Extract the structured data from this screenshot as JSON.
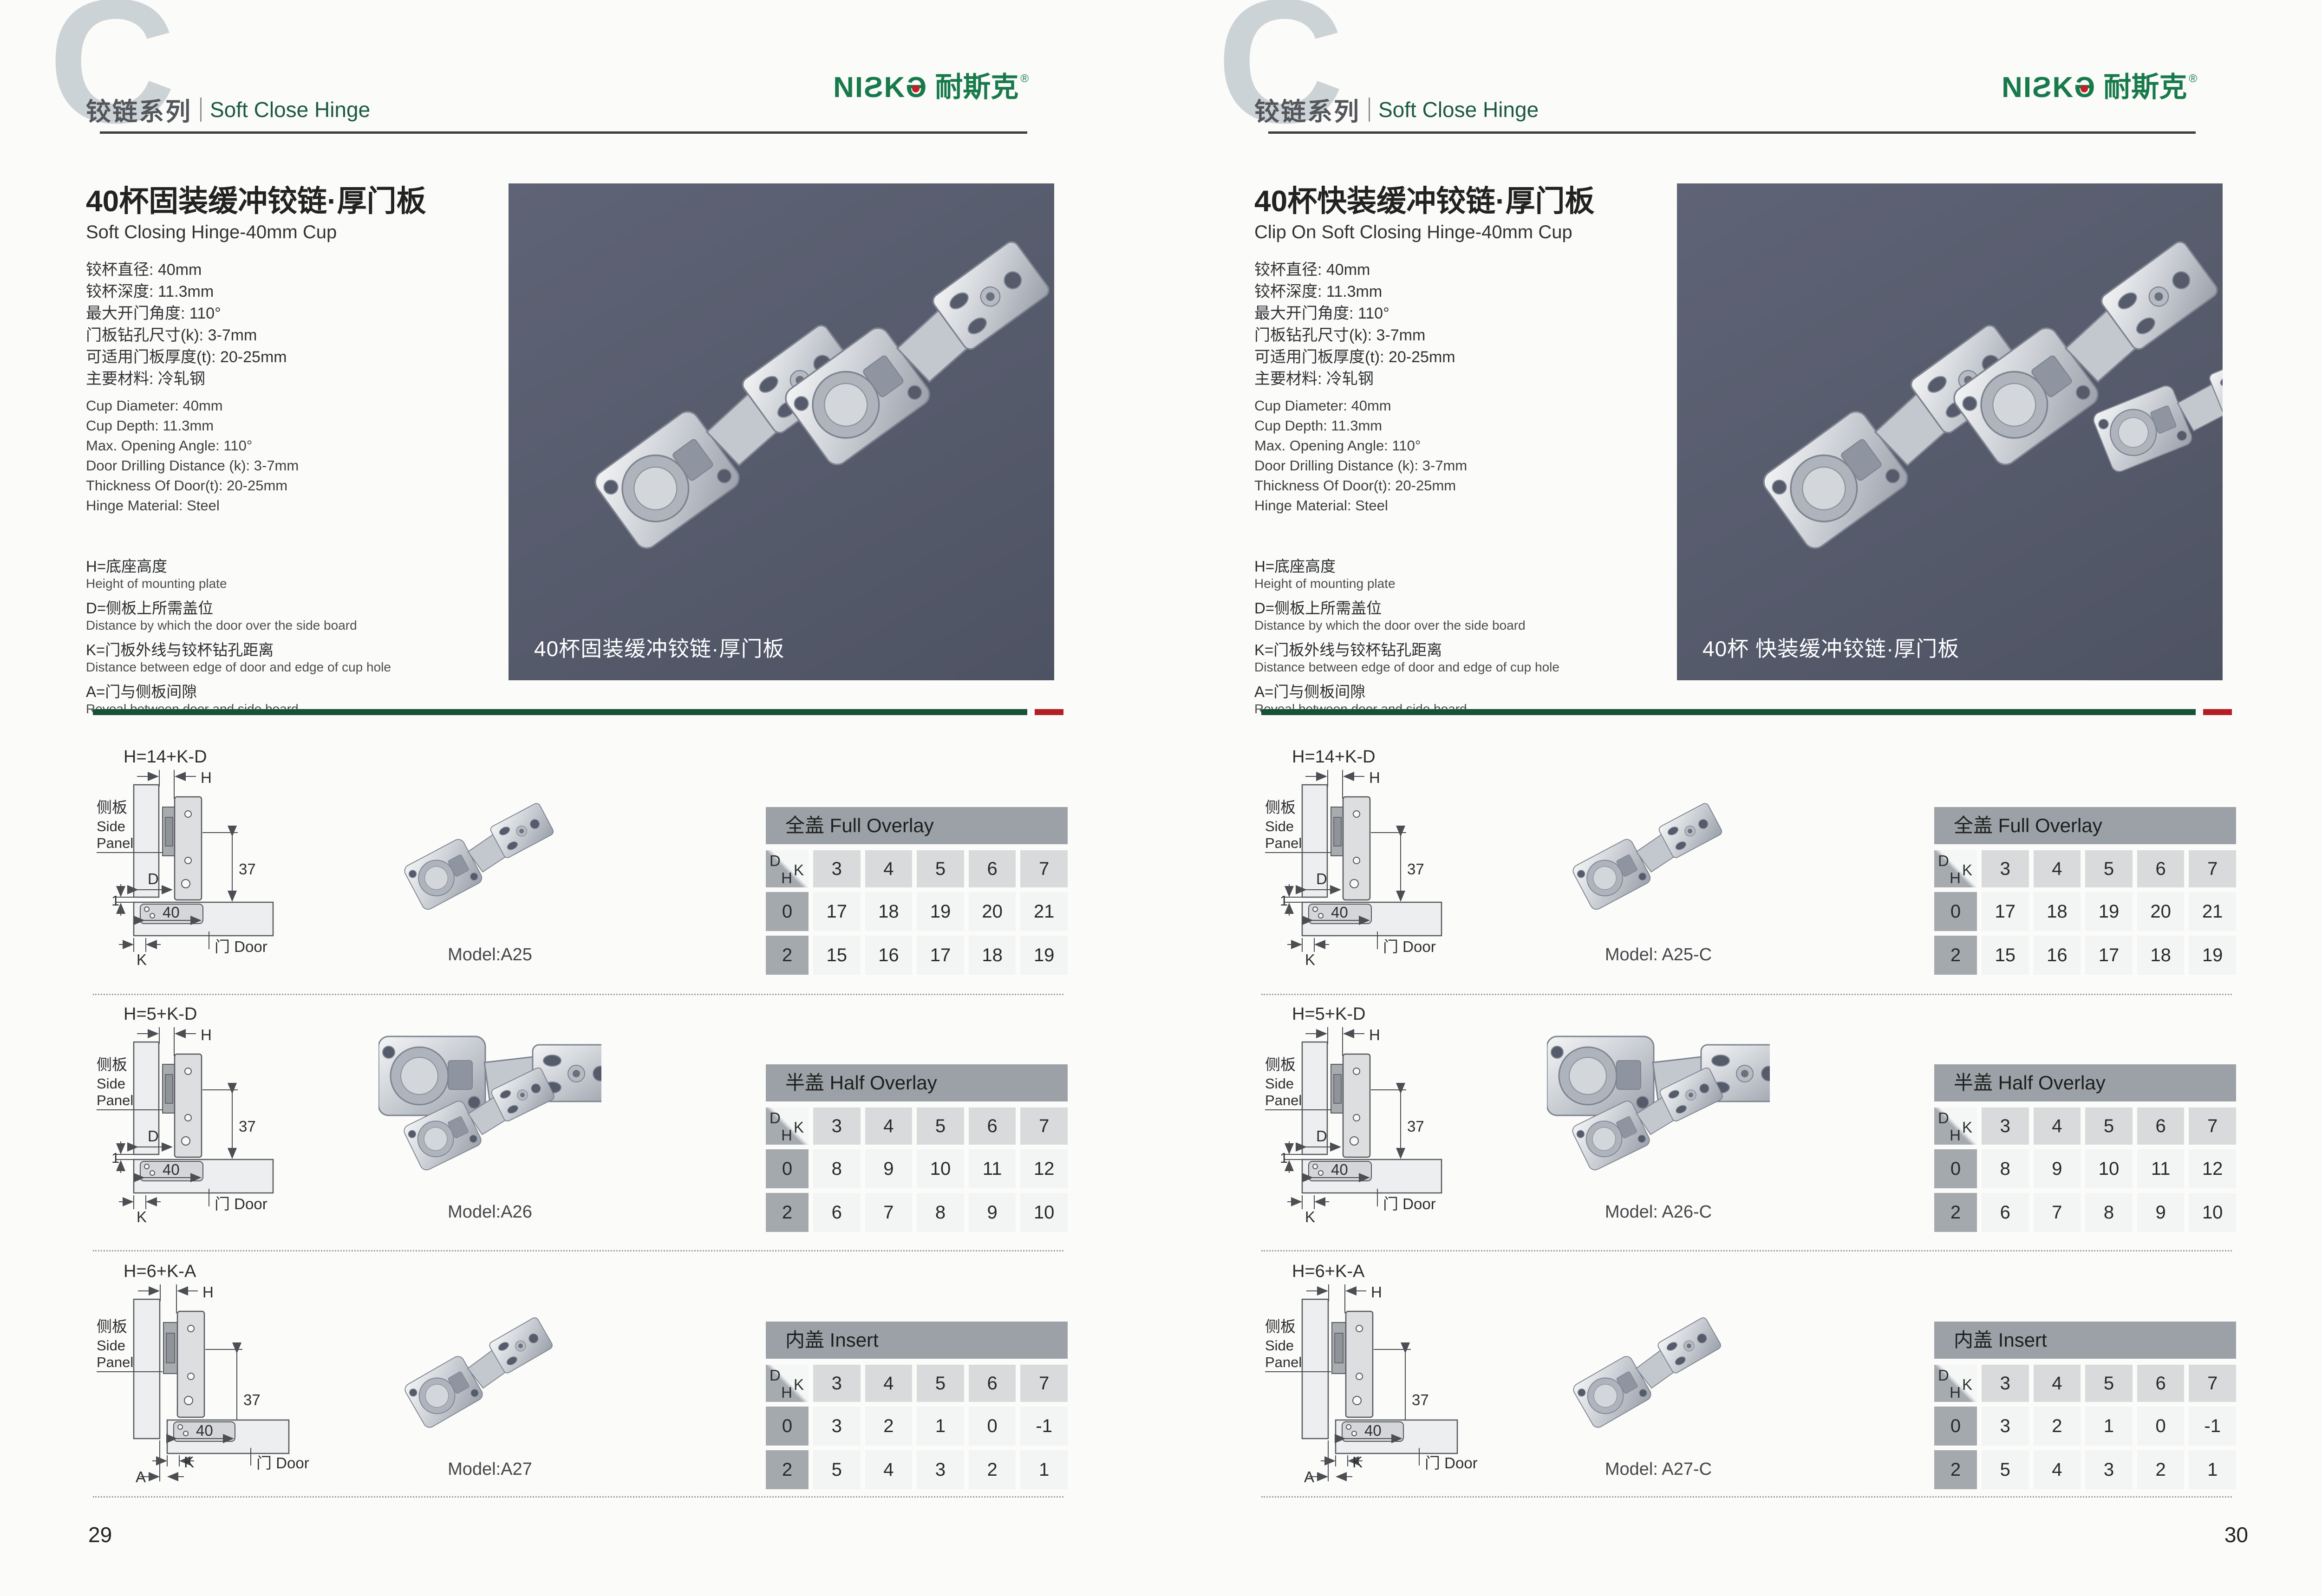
{
  "diagram": {
    "side_cn": "侧板",
    "side_en1": "Side",
    "side_en2": "Panel",
    "door_label": "门 Door",
    "dim_h": "H",
    "dim_d": "D",
    "dim_k": "K",
    "dim_a": "A",
    "dim_1": "1",
    "dim_40": "40",
    "dim_37": "37"
  },
  "pages": [
    {
      "page_number": "29",
      "header": {
        "letter": "C",
        "series_cn": "铰链系列",
        "series_en": "Soft Close Hinge",
        "brand": {
          "prefix": "NIƧK",
          "o": "Ə",
          "cn": "耐斯克",
          "reg": "®"
        }
      },
      "product": {
        "title_cn": "40杯固装缓冲铰链·厚门板",
        "title_en": "Soft Closing Hinge-40mm Cup",
        "specs_cn": [
          "铰杯直径: 40mm",
          "铰杯深度: 11.3mm",
          "最大开门角度: 110°",
          "门板钻孔尺寸(k): 3-7mm",
          "可适用门板厚度(t): 20-25mm",
          "主要材料: 冷轧钢"
        ],
        "specs_en": [
          "Cup Diameter: 40mm",
          "Cup Depth: 11.3mm",
          "Max. Opening Angle: 110°",
          "Door Drilling Distance (k): 3-7mm",
          "Thickness Of Door(t): 20-25mm",
          "Hinge Material: Steel"
        ],
        "notes": [
          {
            "cn": "H=底座高度",
            "en": "Height of mounting plate"
          },
          {
            "cn": "D=侧板上所需盖位",
            "en": "Distance by which the door over the side board"
          },
          {
            "cn": "K=门板外线与铰杯钻孔距离",
            "en": "Distance between edge of door and edge of cup hole"
          },
          {
            "cn": "A=门与侧板间隙",
            "en": "Reveal between door and side board"
          }
        ],
        "photo_caption": "40杯固装缓冲铰链·厚门板"
      },
      "rows": [
        {
          "formula": "H=14+K-D",
          "model": "Model:A25",
          "table": {
            "title": "全盖 Full Overlay",
            "k_values": [
              "3",
              "4",
              "5",
              "6",
              "7"
            ],
            "data_rows": [
              {
                "h": "0",
                "values": [
                  "17",
                  "18",
                  "19",
                  "20",
                  "21"
                ]
              },
              {
                "h": "2",
                "values": [
                  "15",
                  "16",
                  "17",
                  "18",
                  "19"
                ]
              }
            ]
          }
        },
        {
          "formula": "H=5+K-D",
          "model": "Model:A26",
          "table": {
            "title": "半盖 Half Overlay",
            "k_values": [
              "3",
              "4",
              "5",
              "6",
              "7"
            ],
            "data_rows": [
              {
                "h": "0",
                "values": [
                  "8",
                  "9",
                  "10",
                  "11",
                  "12"
                ]
              },
              {
                "h": "2",
                "values": [
                  "6",
                  "7",
                  "8",
                  "9",
                  "10"
                ]
              }
            ]
          }
        },
        {
          "formula": "H=6+K-A",
          "model": "Model:A27",
          "table": {
            "title": "内盖 Insert",
            "k_values": [
              "3",
              "4",
              "5",
              "6",
              "7"
            ],
            "data_rows": [
              {
                "h": "0",
                "values": [
                  "3",
                  "2",
                  "1",
                  "0",
                  "-1"
                ]
              },
              {
                "h": "2",
                "values": [
                  "5",
                  "4",
                  "3",
                  "2",
                  "1"
                ]
              }
            ]
          }
        }
      ]
    },
    {
      "page_number": "30",
      "header": {
        "letter": "C",
        "series_cn": "铰链系列",
        "series_en": "Soft Close Hinge",
        "brand": {
          "prefix": "NIƧK",
          "o": "Ə",
          "cn": "耐斯克",
          "reg": "®"
        }
      },
      "product": {
        "title_cn": "40杯快装缓冲铰链·厚门板",
        "title_en": "Clip On Soft Closing Hinge-40mm Cup",
        "specs_cn": [
          "铰杯直径: 40mm",
          "铰杯深度: 11.3mm",
          "最大开门角度: 110°",
          "门板钻孔尺寸(k): 3-7mm",
          "可适用门板厚度(t): 20-25mm",
          "主要材料: 冷轧钢"
        ],
        "specs_en": [
          "Cup Diameter: 40mm",
          "Cup Depth: 11.3mm",
          "Max. Opening Angle: 110°",
          "Door Drilling Distance (k): 3-7mm",
          "Thickness Of Door(t): 20-25mm",
          "Hinge Material: Steel"
        ],
        "notes": [
          {
            "cn": "H=底座高度",
            "en": "Height of mounting plate"
          },
          {
            "cn": "D=侧板上所需盖位",
            "en": "Distance by which the door over the side board"
          },
          {
            "cn": "K=门板外线与铰杯钻孔距离",
            "en": "Distance between edge of door and edge of cup hole"
          },
          {
            "cn": "A=门与侧板间隙",
            "en": "Reveal between door and side board"
          }
        ],
        "photo_caption": "40杯 快装缓冲铰链·厚门板"
      },
      "rows": [
        {
          "formula": "H=14+K-D",
          "model": "Model: A25-C",
          "table": {
            "title": "全盖 Full Overlay",
            "k_values": [
              "3",
              "4",
              "5",
              "6",
              "7"
            ],
            "data_rows": [
              {
                "h": "0",
                "values": [
                  "17",
                  "18",
                  "19",
                  "20",
                  "21"
                ]
              },
              {
                "h": "2",
                "values": [
                  "15",
                  "16",
                  "17",
                  "18",
                  "19"
                ]
              }
            ]
          }
        },
        {
          "formula": "H=5+K-D",
          "model": "Model: A26-C",
          "table": {
            "title": "半盖 Half Overlay",
            "k_values": [
              "3",
              "4",
              "5",
              "6",
              "7"
            ],
            "data_rows": [
              {
                "h": "0",
                "values": [
                  "8",
                  "9",
                  "10",
                  "11",
                  "12"
                ]
              },
              {
                "h": "2",
                "values": [
                  "6",
                  "7",
                  "8",
                  "9",
                  "10"
                ]
              }
            ]
          }
        },
        {
          "formula": "H=6+K-A",
          "model": "Model: A27-C",
          "table": {
            "title": "内盖 Insert",
            "k_values": [
              "3",
              "4",
              "5",
              "6",
              "7"
            ],
            "data_rows": [
              {
                "h": "0",
                "values": [
                  "3",
                  "2",
                  "1",
                  "0",
                  "-1"
                ]
              },
              {
                "h": "2",
                "values": [
                  "5",
                  "4",
                  "3",
                  "2",
                  "1"
                ]
              }
            ]
          }
        }
      ]
    }
  ]
}
